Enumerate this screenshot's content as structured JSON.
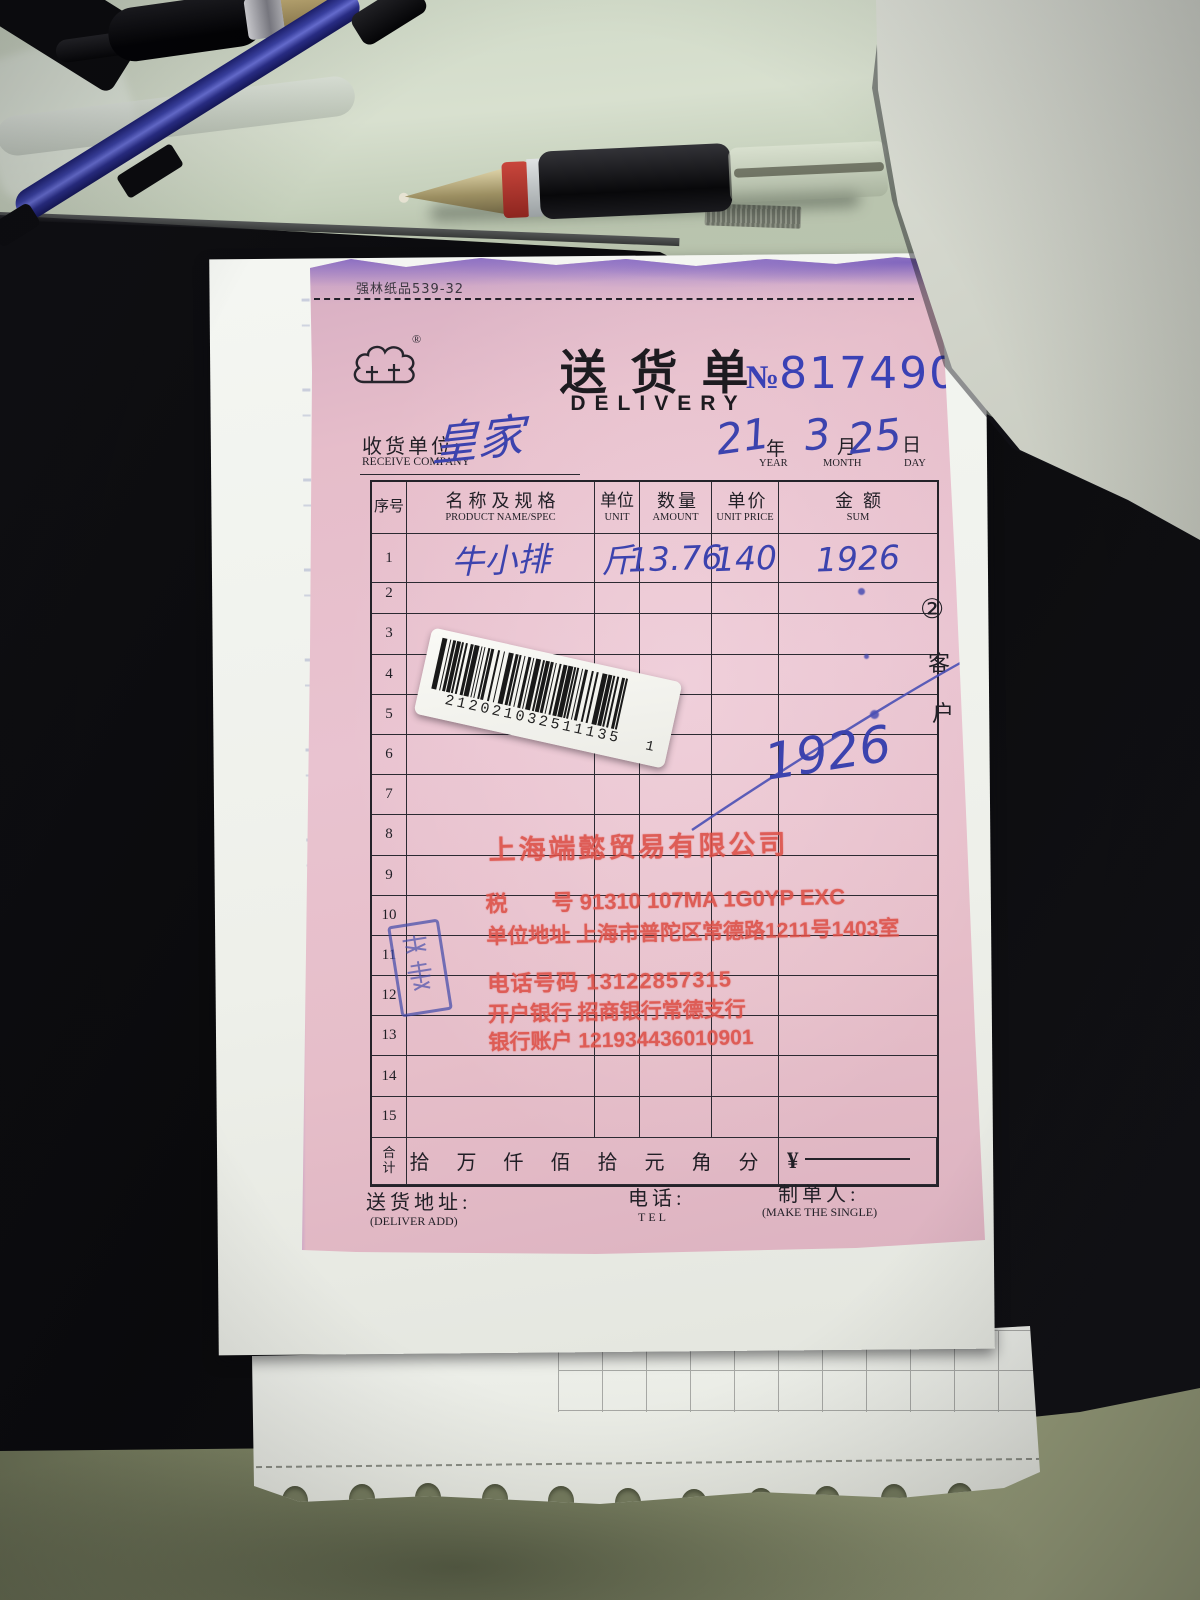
{
  "form": {
    "paper_code": "强林纸品539-32",
    "logo": {
      "registered_mark": "®"
    },
    "title": {
      "cn": "送货单",
      "en": "DELIVERY"
    },
    "serial": {
      "prefix": "№",
      "number": "8174907"
    },
    "receiver": {
      "label_cn": "收货单位:",
      "label_en": "RECEIVE COMPANY",
      "value": "皇家"
    },
    "date": {
      "year": {
        "value": "21",
        "cn": "年",
        "en": "YEAR"
      },
      "month": {
        "value": "3",
        "cn": "月",
        "en": "MONTH"
      },
      "day": {
        "value": "25",
        "cn": "日",
        "en": "DAY"
      }
    },
    "table": {
      "headers": {
        "index_cn": "序号",
        "name_cn": "名称及规格",
        "name_en": "PRODUCT NAME/SPEC",
        "unit_cn": "单位",
        "unit_en": "UNIT",
        "amount_cn": "数量",
        "amount_en": "AMOUNT",
        "price_cn": "单价",
        "price_en": "UNIT PRICE",
        "sum_cn": "金额",
        "sum_en": "SUM"
      },
      "rows": [
        {
          "no": "1",
          "name": "牛小排",
          "unit": "斤",
          "amount": "13.76",
          "price": "140",
          "sum": "1926"
        },
        {
          "no": "2",
          "name": "",
          "unit": "",
          "amount": "",
          "price": "",
          "sum": ""
        },
        {
          "no": "3",
          "name": "",
          "unit": "",
          "amount": "",
          "price": "",
          "sum": ""
        },
        {
          "no": "4",
          "name": "",
          "unit": "",
          "amount": "",
          "price": "",
          "sum": ""
        },
        {
          "no": "5",
          "name": "",
          "unit": "",
          "amount": "",
          "price": "",
          "sum": ""
        },
        {
          "no": "6",
          "name": "",
          "unit": "",
          "amount": "",
          "price": "",
          "sum": ""
        },
        {
          "no": "7",
          "name": "",
          "unit": "",
          "amount": "",
          "price": "",
          "sum": ""
        },
        {
          "no": "8",
          "name": "",
          "unit": "",
          "amount": "",
          "price": "",
          "sum": ""
        },
        {
          "no": "9",
          "name": "",
          "unit": "",
          "amount": "",
          "price": "",
          "sum": ""
        },
        {
          "no": "10",
          "name": "",
          "unit": "",
          "amount": "",
          "price": "",
          "sum": ""
        },
        {
          "no": "11",
          "name": "",
          "unit": "",
          "amount": "",
          "price": "",
          "sum": ""
        },
        {
          "no": "12",
          "name": "",
          "unit": "",
          "amount": "",
          "price": "",
          "sum": ""
        },
        {
          "no": "13",
          "name": "",
          "unit": "",
          "amount": "",
          "price": "",
          "sum": ""
        },
        {
          "no": "14",
          "name": "",
          "unit": "",
          "amount": "",
          "price": "",
          "sum": ""
        },
        {
          "no": "15",
          "name": "",
          "unit": "",
          "amount": "",
          "price": "",
          "sum": ""
        }
      ],
      "total": {
        "label_line1": "合",
        "label_line2": "计",
        "digits": "拾万仟佰拾元角分",
        "currency": "¥"
      }
    },
    "annotations": {
      "crossout_total": "1926",
      "copy_circle": "②",
      "copy_char1": "客",
      "copy_char2": "户"
    },
    "barcode": {
      "number": "212021032511135",
      "suffix": "1"
    },
    "stamp": {
      "company": "上海端懿贸易有限公司",
      "tax_line": "税　　号 91310 107MA 1G0YP EXC",
      "addr_line": "单位地址 上海市普陀区常德路1211号1403室",
      "phone_line": "电话号码 13122857315",
      "bank_line": "开户银行 招商银行常德支行",
      "acct_line": "银行账户 121934436010901"
    },
    "footer": {
      "deliver_cn": "送货地址:",
      "deliver_en": "(DELIVER ADD)",
      "tel_cn": "电话:",
      "tel_en": "TEL",
      "maker_cn": "制单人:",
      "maker_en": "(MAKE THE SINGLE)"
    }
  },
  "colors": {
    "ink_blue": "#3c43ae",
    "serial_blue": "#3a41b5",
    "stamp_red": "#dd4f46",
    "paper_pink": "#e6bdca"
  }
}
